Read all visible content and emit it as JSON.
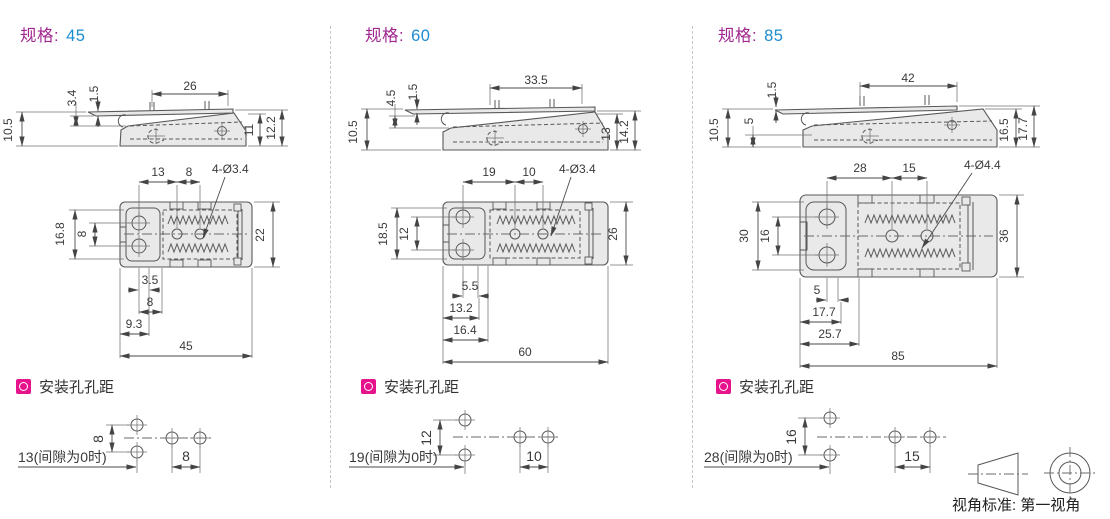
{
  "colors": {
    "spec_label": "#A12790",
    "spec_value": "#1C8CD0",
    "section_icon": "#E7138C",
    "drawing_line": "#585858",
    "body_fill": "#E9E9E9"
  },
  "footer": {
    "view_label": "视角标准:",
    "view_value": "第一视角"
  },
  "panels": [
    {
      "spec_label": "规格:",
      "spec_value": "45",
      "section_title": "安装孔孔距",
      "side": {
        "top": "26",
        "v1": "3.4",
        "v2": "1.5",
        "h_left": "10.5",
        "r1": "11",
        "r2": "12.2"
      },
      "plan": {
        "t1": "13",
        "t2": "8",
        "holes": "4-Ø3.4",
        "l1": "16.8",
        "l2": "8",
        "r1": "22",
        "b1": "3.5",
        "b2": "8",
        "b3": "9.3",
        "b4": "45"
      },
      "mount": {
        "v": "8",
        "h": "8",
        "note": "13(间隙为0时)"
      }
    },
    {
      "spec_label": "规格:",
      "spec_value": "60",
      "section_title": "安装孔孔距",
      "side": {
        "top": "33.5",
        "v1": "4.5",
        "v2": "1.5",
        "h_left": "10.5",
        "r1": "13",
        "r2": "14.2"
      },
      "plan": {
        "t1": "19",
        "t2": "10",
        "holes": "4-Ø3.4",
        "l1": "18.5",
        "l2": "12",
        "r1": "26",
        "b1": "5.5",
        "b2": "13.2",
        "b3": "16.4",
        "b4": "60"
      },
      "mount": {
        "v": "12",
        "h": "10",
        "note": "19(间隙为0时)"
      }
    },
    {
      "spec_label": "规格:",
      "spec_value": "85",
      "section_title": "安装孔孔距",
      "side": {
        "top": "42",
        "v1": "5",
        "v2": "1.5",
        "h_left": "10.5",
        "r1": "16.5",
        "r2": "17.7"
      },
      "plan": {
        "t1": "28",
        "t2": "15",
        "holes": "4-Ø4.4",
        "l1": "30",
        "l2": "16",
        "r1": "36",
        "b1": "5",
        "b2": "17.7",
        "b3": "25.7",
        "b4": "85"
      },
      "mount": {
        "v": "16",
        "h": "15",
        "note": "28(间隙为0时)"
      }
    }
  ]
}
